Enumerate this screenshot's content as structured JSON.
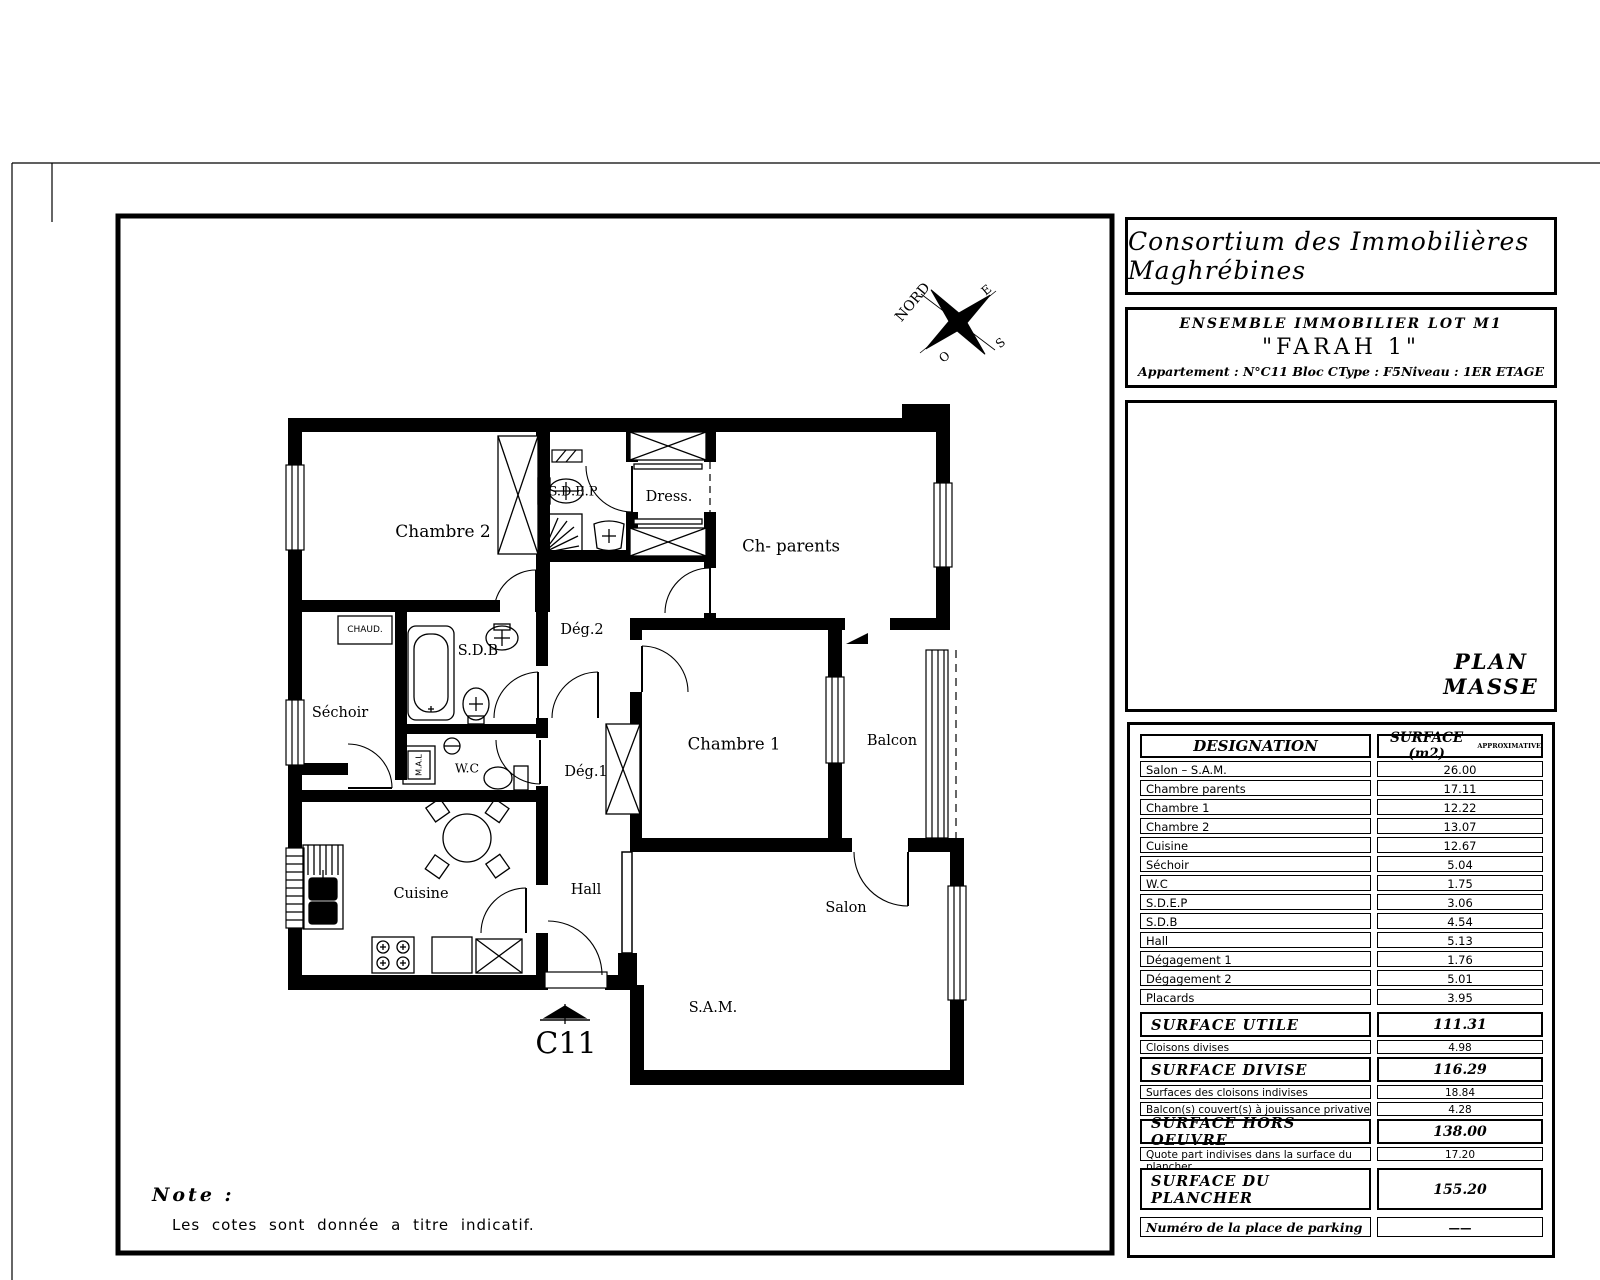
{
  "header": {
    "company": "Consortium des Immobilières Maghrébines",
    "project_line": "ENSEMBLE   IMMOBILIER  LOT  M1",
    "project_name": "\"FARAH 1\"",
    "apartment": "Appartement :  N°C11  Bloc C",
    "type": "Type : F5",
    "level": "Niveau : 1ER ETAGE"
  },
  "plan": {
    "unit_code": "C11",
    "compass": {
      "north": "NORD",
      "east": "E",
      "west": "O",
      "south": "S"
    },
    "labels": {
      "chambre2": "Chambre 2",
      "sdep": "S.D.E.P",
      "dress": "Dress.",
      "ch_parents": "Ch- parents",
      "deg2": "Dég.2",
      "sdb": "S.D.B",
      "chaud": "CHAUD.",
      "sechoir": "Séchoir",
      "mal": "M.A.L",
      "wc": "W.C",
      "deg1": "Dég.1",
      "chambre1": "Chambre 1",
      "balcon": "Balcon",
      "cuisine": "Cuisine",
      "hall": "Hall",
      "salon": "Salon",
      "sam": "S.A.M."
    }
  },
  "plan_masse": {
    "title_line1": "PLAN",
    "title_line2": "MASSE"
  },
  "surface_table": {
    "header": {
      "designation": "DESIGNATION",
      "surface": "SURFACE  (m2)",
      "surface_note": "APPROXIMATIVE"
    },
    "rows": [
      {
        "label": "Salon – S.A.M.",
        "value": "26.00"
      },
      {
        "label": "Chambre parents",
        "value": "17.11"
      },
      {
        "label": "Chambre 1",
        "value": "12.22"
      },
      {
        "label": "Chambre 2",
        "value": "13.07"
      },
      {
        "label": "Cuisine",
        "value": "12.67"
      },
      {
        "label": "Séchoir",
        "value": "5.04"
      },
      {
        "label": "W.C",
        "value": "1.75"
      },
      {
        "label": "S.D.E.P",
        "value": "3.06"
      },
      {
        "label": "S.D.B",
        "value": "4.54"
      },
      {
        "label": "Hall",
        "value": "5.13"
      },
      {
        "label": "Dégagement 1",
        "value": "1.76"
      },
      {
        "label": "Dégagement 2",
        "value": "5.01"
      },
      {
        "label": "Placards",
        "value": "3.95"
      }
    ],
    "summaries": [
      {
        "label": "SURFACE UTILE",
        "value": "111.31"
      },
      {
        "label": "Cloisons divises",
        "value": "4.98"
      },
      {
        "label": "SURFACE DIVISE",
        "value": "116.29"
      },
      {
        "label": "Surfaces des cloisons indivises",
        "value": "18.84"
      },
      {
        "label": "Balcon(s) couvert(s) à jouissance privative",
        "value": "4.28"
      },
      {
        "label": "SURFACE HORS OEUVRE",
        "value": "138.00"
      },
      {
        "label": "Quote part indivises dans la surface du plancher",
        "value": "17.20"
      }
    ],
    "plancher": {
      "label": "SURFACE DU PLANCHER",
      "value": "155.20"
    },
    "parking": {
      "label": "Numéro de la place de parking",
      "value": "——"
    }
  },
  "note": {
    "title": "Note :",
    "body": "Les cotes sont donnée a titre indicatif."
  }
}
